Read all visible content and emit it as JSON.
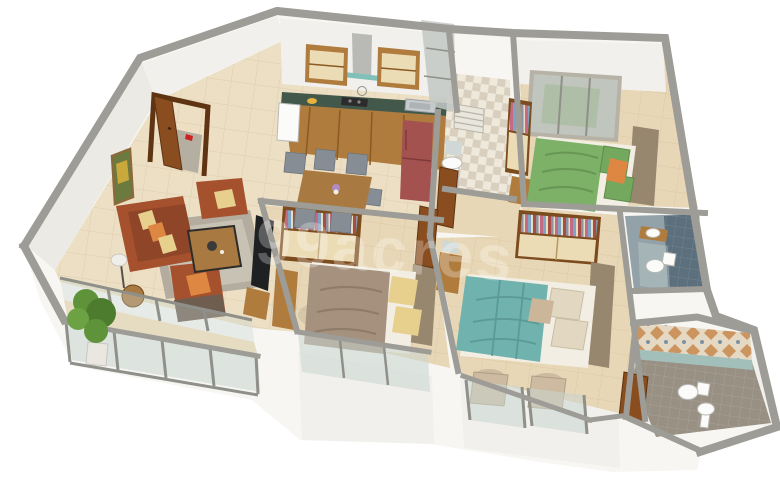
{
  "watermark": {
    "text": "99acres"
  },
  "scene": {
    "type": "3d-isometric-floor-plan",
    "description": "rendered 3BHK apartment cutaway top view",
    "rooms": [
      {
        "id": "entrance-foyer",
        "items": [
          "wooden-entry-door",
          "doormat",
          "red-accent"
        ]
      },
      {
        "id": "living-room",
        "items": [
          "rust-three-seater-sofa",
          "rust-armchair",
          "rust-armchair",
          "coffee-table",
          "grey-rug",
          "side-table",
          "floor-lamp",
          "wall-tv",
          "tv-console",
          "wall-art"
        ]
      },
      {
        "id": "dining-area",
        "items": [
          "wooden-dining-table",
          "grey-chair",
          "grey-chair",
          "grey-chair",
          "grey-chair",
          "grey-chair",
          "flower-vase"
        ]
      },
      {
        "id": "kitchen",
        "items": [
          "green-granite-l-counter",
          "base-cabinets",
          "upper-cabinet",
          "upper-cabinet",
          "chimney-hood",
          "gas-hob",
          "kettle",
          "steel-sink",
          "fruit-bowl",
          "red-refrigerator",
          "white-appliance"
        ]
      },
      {
        "id": "utility-area",
        "items": [
          "checkered-tile-floor",
          "pedestal-washbasin",
          "mirror",
          "louver-window",
          "glazed-shaft"
        ]
      },
      {
        "id": "bedroom-green",
        "items": [
          "green-double-bed",
          "orange-accent-pillow",
          "large-sliding-window",
          "open-wardrobe-with-clothes",
          "side-cabinet"
        ]
      },
      {
        "id": "common-bathroom",
        "items": [
          "slate-tiled-wall",
          "toilet",
          "counter-washbasin",
          "glass-shower-partition"
        ]
      },
      {
        "id": "bedroom-second",
        "items": [
          "taupe-double-bed",
          "yellow-pillows",
          "open-wardrobe-with-clothes",
          "dresser",
          "full-height-window"
        ]
      },
      {
        "id": "corridor",
        "items": [
          "wooden-door",
          "wooden-door"
        ]
      },
      {
        "id": "master-bedroom",
        "items": [
          "teal-double-bed",
          "cream-pillows",
          "open-wardrobe-with-clothes",
          "dresser-with-mirror",
          "accent-chair",
          "accent-chair",
          "french-window"
        ]
      },
      {
        "id": "master-bathroom",
        "items": [
          "patterned-tile-wall",
          "wall-hung-toilet",
          "pedestal-washbasin",
          "wooden-door"
        ]
      },
      {
        "id": "balcony",
        "items": [
          "glass-railing",
          "glass-partition",
          "potted-plant"
        ]
      }
    ]
  },
  "colors": {
    "bg": "#ffffff",
    "wall_face": "#f7f6f3",
    "wall_band": "#f2f0ec",
    "wall_side": "#eceae5",
    "wall_cap": "#9d9c96",
    "floor": "#ecdfc4",
    "floor_warm": "#e8d7b6",
    "balcony_floor": "#e6dcc2",
    "glass": "#c9d6d0",
    "frame_grey": "#90908a",
    "wood": "#b07c3e",
    "wood_dark": "#7c4b1e",
    "cream_panel": "#ecdcb6",
    "counter_green": "#42584a",
    "fridge_red": "#a45250",
    "sofa_rust": "#a5512e",
    "sofa_dark": "#6f5d50",
    "cushion_yellow": "#e7cf8e",
    "cushion_orange": "#de8742",
    "rug": "#b3ac9f",
    "rug_inner": "#c8c2b4",
    "chair_grey": "#868d95",
    "table_wood": "#a87a42",
    "bed_green": "#7cb167",
    "bed_taupe": "#a5917e",
    "bed_teal": "#6fb2ae",
    "pillow_cream": "#e2d8c2",
    "mattress": "#f2eee3",
    "headboard": "#98876f",
    "tile_slate": "#5b6f7c",
    "bath1_floor": "#93a1a8",
    "bath2_floor": "#999084",
    "pattern_orange": "#c8894e",
    "pattern_blue": "#7b92a6",
    "pattern_bg": "#e5d9c4",
    "white_fixture": "#fbfbfa",
    "tv_dark": "#1f2022",
    "door_wood": "#8a4d1f",
    "plant_green": "#5f9339",
    "doormat": "#b5afa2",
    "checker_a": "#efe9db",
    "checker_b": "#d9cfbf",
    "watermark_color": "#ffffff"
  }
}
